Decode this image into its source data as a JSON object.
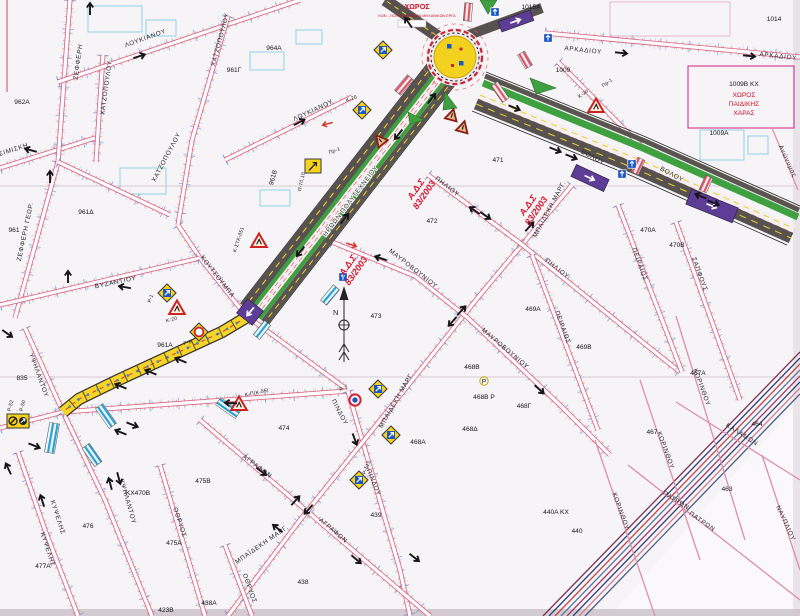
{
  "title": {
    "main": "ΧΩΡΟΣ",
    "sub": "ΚΩΝ - ΠΟΛΕΟΔΟΜΙΚΩΝ ΜΗΧΑΝΙΚΩΝ ΕΡΓΑ"
  },
  "playground": {
    "block": "1009Β ΚΧ",
    "l1": "ΧΩΡΟΣ",
    "l2": "ΠΑΙΔΙΚΗΣ",
    "l3": "ΧΑΡΑΣ"
  },
  "annotation": {
    "l1": "Α.Δ.Σ",
    "l2": "83/2003"
  },
  "compass": {
    "north": "N"
  },
  "blocks": {
    "b962a": "962Α",
    "b961": "961",
    "b961d": "961Δ",
    "b961g": "961Γ",
    "b961b": "961Β",
    "b964a": "964Α",
    "b961a": "961Α",
    "b835": "835",
    "b1015a": "1015Α",
    "b1009": "1009",
    "b1009a": "1009Α",
    "b1014": "1014",
    "b471": "471",
    "b472": "472",
    "b470a": "470Α",
    "b470b": "470Β",
    "b473": "473",
    "b469a": "469Α",
    "b469b": "469Β",
    "b468a": "468Α",
    "b468b": "468Β",
    "b468bp": "468Β Ρ",
    "p_circle": "Ρ",
    "b468g": "468Γ",
    "b468d": "468Δ",
    "b474": "474",
    "b475a": "475Α",
    "b475b": "475Β",
    "b476": "476",
    "b477a": "477Α",
    "bkx470b": "ΚΧ470Β",
    "b438": "438",
    "b438a": "438Α",
    "b423b": "423Β",
    "b439": "439",
    "b467": "467",
    "b467a": "467Α",
    "b464": "464",
    "b463": "463",
    "b440": "440",
    "b440a": "440Α ΚΧ"
  },
  "streets": {
    "tsimiski": "ΤΣΙΜΙΣΚΗ",
    "zefferi": "ΖΕΦΦΕΡΗ",
    "zefferi_geor": "ΖΕΦΦΕΡΗ ΓΕΩΡ.",
    "loukianou": "ΛΟΥΚΙΑΝΟΥ",
    "xatzopoulou": "ΧΑΤΖΟΠΟΥΛΟΥ",
    "vyzantiou": "ΒΥΖΑΝΤΙΟΥ",
    "koutsoumpa": "ΚΟΥΤΣΟΥΜΠΑ",
    "ypsilantou": "ΥΨΗΛΑΝΤΟΥ",
    "kypselis": "ΚΥΨΕΛΗΣ",
    "othryos": "ΟΘΡΥΟΣ",
    "iroon": "ΗΡΩΩΝ ΠΟΛΥΤΕΧΝΕΙΟΥ",
    "mayrovouniou": "ΜΑΥΡΟΒΟΥΝΙΟΥ",
    "mpaideki": "ΜΠΑΪΔΕΚΗ ΜΑΡΓ.",
    "piliou": "ΠΗΛΙΟΥ",
    "pindou": "ΠΙΝΔΟΥ",
    "peiraios": "ΠΕΙΡΑΙΩΣ",
    "sapfous": "ΣΑΠΦΟΥΣ",
    "volou": "ΒΟΛΟΥ",
    "arkadiou": "ΑΡΚΑΔΙΟΥ",
    "anonymos": "Ανώνυμος",
    "agrafon": "ΑΓΡΑΦΩΝ",
    "korinthou": "ΚΟΡΙΝΘΟΥ",
    "kalamon": "ΚΑΛΑΜΩΝ",
    "patron": "ΠΑΤΡΩΝ",
    "nayplioy": "ΝΑΥΠΛΙΟΥ"
  },
  "signs": {
    "k20": "Κ-20",
    "kstk": "Κ-ΣΤΚ-δ51",
    "kp_kd5": "Κ-Π(Κ-δ5)",
    "r1": "Ρ-1",
    "r6": "Ρ-6",
    "r7": "Ρ-7",
    "r52": "Ρ-52",
    "r50": "Ρ-50",
    "rd15": "Ρ-δ15",
    "pr1": "Πρ-1",
    "p70_10": "Π-70,10"
  },
  "colors": {
    "street_pink": "#d9607d",
    "road_gray": "#575250",
    "road_green": "#3fa040",
    "roundabout_yellow": "#f2d21f",
    "bus_yellow": "#f6d529",
    "works_purple": "#5e3d96",
    "crosswalk_blue": "#2e9fd0",
    "annotation_red": "#d6132c",
    "parcel_cyan": "#8fd2e4",
    "paper": "#f7f4f7"
  }
}
